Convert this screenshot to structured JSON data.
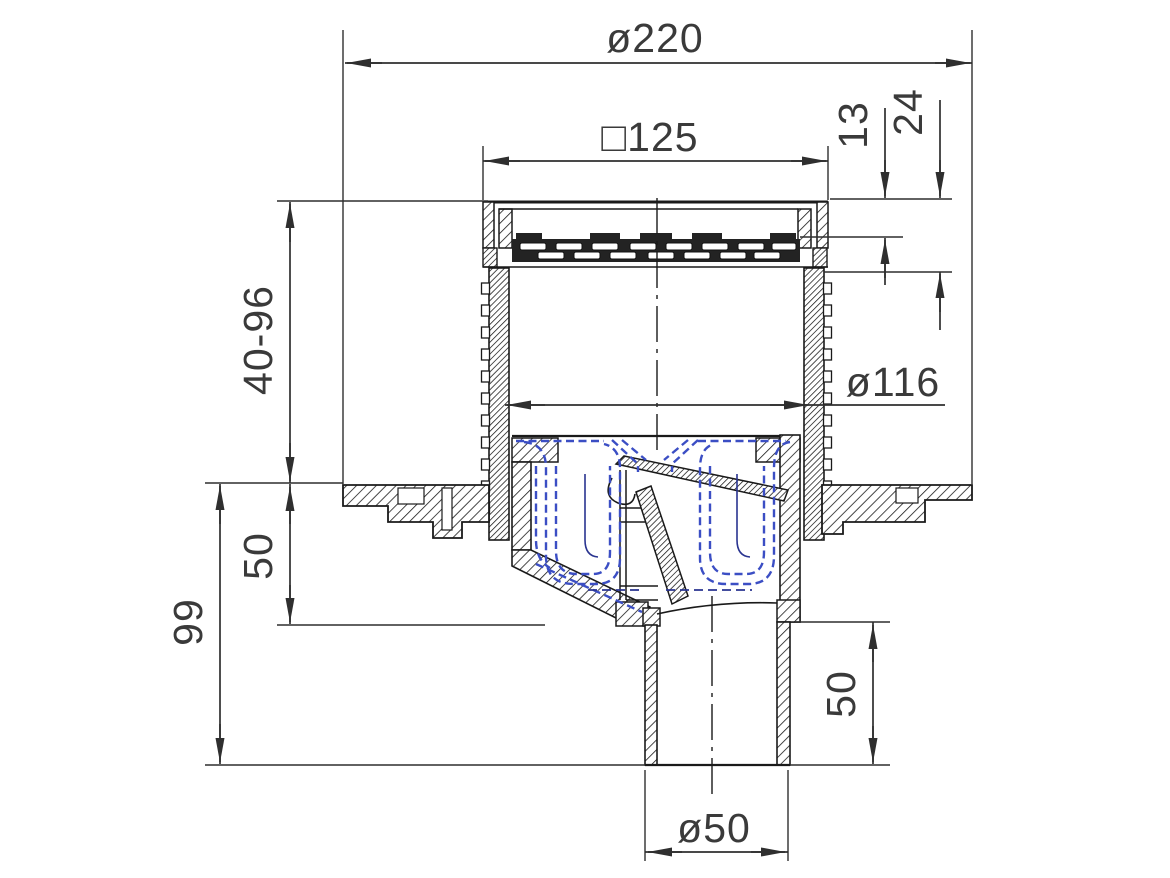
{
  "drawing": {
    "kind": "technical-section-drawing",
    "subject": "floor drain with vertical outlet, telescopic grate assembly and odour trap insert",
    "units": "mm",
    "colors": {
      "background": "#ffffff",
      "outline": "#1a1a1a",
      "dimension": "#2f2f2f",
      "trap_insert_blue": "#3b4ec4",
      "trap_insert_navy": "#2a3490"
    },
    "labels": {
      "dia220": "ø220",
      "sq125": "□125",
      "d13": "13",
      "d24": "24",
      "h40_96": "40-96",
      "dia116": "ø116",
      "d50_left": "50",
      "d99": "99",
      "d50_right": "50",
      "dia50": "ø50"
    }
  }
}
